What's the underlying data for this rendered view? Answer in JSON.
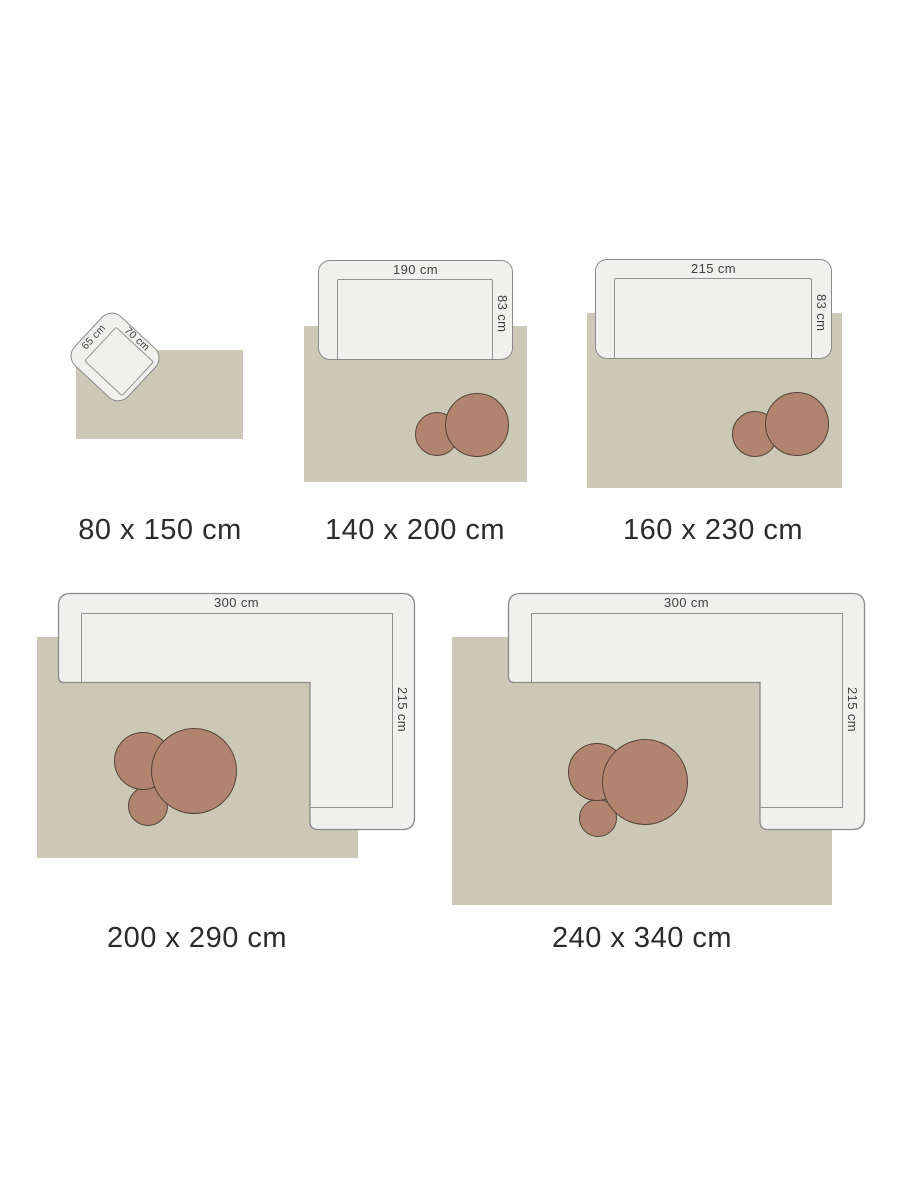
{
  "colors": {
    "rug": "#cbc9b5",
    "sofa_fill": "#f0f0ee",
    "sofa_border": "#8a8a8a",
    "pouf_fill": "#b1846f",
    "pouf_border": "#55433a",
    "caption_text": "#2b2b2b",
    "dimension_text": "#404040",
    "background": "#ffffff"
  },
  "panels": [
    {
      "caption": "80 x 150 cm",
      "furniture": "armchair",
      "furniture_dims": {
        "width": "65 cm",
        "depth": "70 cm"
      }
    },
    {
      "caption": "140 x 200 cm",
      "furniture": "sofa",
      "furniture_dims": {
        "width": "190 cm",
        "depth": "83 cm"
      }
    },
    {
      "caption": "160 x 230 cm",
      "furniture": "sofa",
      "furniture_dims": {
        "width": "215 cm",
        "depth": "83 cm"
      }
    },
    {
      "caption": "200 x 290 cm",
      "furniture": "corner-sofa",
      "furniture_dims": {
        "width": "300 cm",
        "depth": "215 cm"
      }
    },
    {
      "caption": "240 x 340 cm",
      "furniture": "corner-sofa",
      "furniture_dims": {
        "width": "300 cm",
        "depth": "215 cm"
      }
    }
  ]
}
